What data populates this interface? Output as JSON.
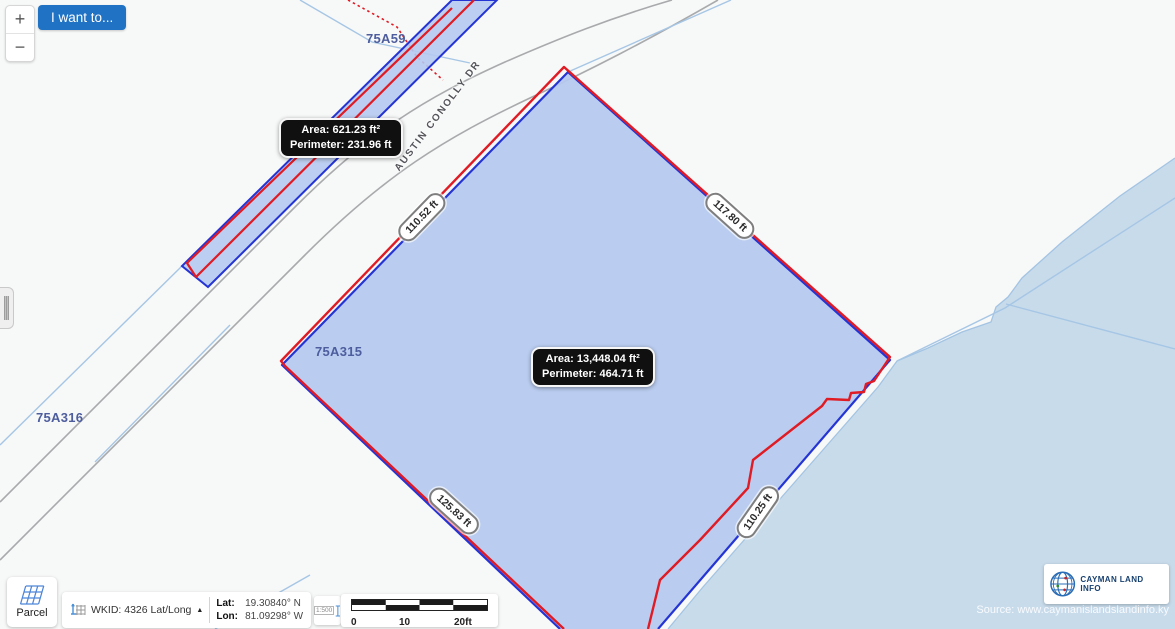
{
  "controls": {
    "zoom_in": "+",
    "zoom_out": "−",
    "i_want_to": "I want to..."
  },
  "map": {
    "street": "AUSTIN CONOLLY DR",
    "parcels": {
      "a59": "75A59",
      "a315": "75A315",
      "a316": "75A316"
    },
    "measurements": {
      "nw": "110.52 ft",
      "ne": "117.80 ft",
      "sw": "125.83 ft",
      "se": "110.25 ft",
      "hidden": "ft"
    },
    "tooltip_small": {
      "area": "Area: 621.23 ft²",
      "perimeter": "Perimeter: 231.96 ft"
    },
    "tooltip_large": {
      "area": "Area: 13,448.04 ft²",
      "perimeter": "Perimeter: 464.71 ft"
    }
  },
  "statusbar": {
    "parcel_tool": "Parcel",
    "wkid": "WKID: 4326 Lat/Long",
    "lat_label": "Lat:",
    "lat_value": "19.30840° N",
    "lon_label": "Lon:",
    "lon_value": "81.09298° W",
    "scale_ratio": "1:500",
    "scale_ticks": [
      "0",
      "10",
      "20ft"
    ]
  },
  "attribution": {
    "logo": "CAYMAN LAND INFO",
    "source": "Source: www.caymanislandslandinfo.ky"
  },
  "colors": {
    "selection_red": "#e01b24",
    "parcel_blue": "#2534d4",
    "parcel_fill": "#b5c9ef",
    "water": "#c8dbeb",
    "accent_blue": "#1f72c4"
  }
}
